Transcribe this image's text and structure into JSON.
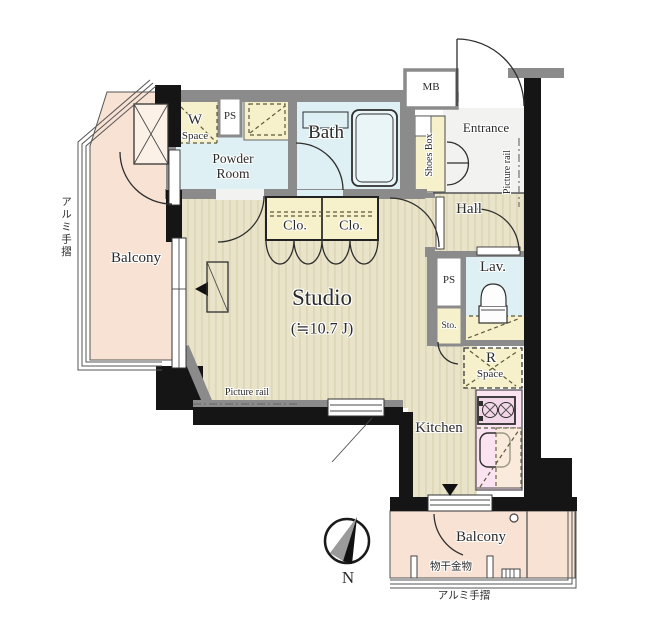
{
  "labels": {
    "balcony_left": "Balcony",
    "handrail_left": "アルミ手摺",
    "w_space": {
      "letter": "W",
      "word": "Space"
    },
    "ps_top": "PS",
    "powder_room": {
      "line1": "Powder",
      "line2": "Room"
    },
    "bath": "Bath",
    "mb": "MB",
    "entrance": "Entrance",
    "shoes_box": "Shoes Box",
    "picture_rail_entrance": "Picture rail",
    "hall": "Hall",
    "lav": "Lav.",
    "ps_hall": "PS",
    "sto": "Sto.",
    "r_space": {
      "letter": "R",
      "word": "Space"
    },
    "studio": {
      "name": "Studio",
      "size": "(≒10.7 J)"
    },
    "picture_rail_studio": "Picture rail",
    "kitchen": "Kitchen",
    "closet_left": "Clo.",
    "closet_right": "Clo.",
    "balcony_bottom": "Balcony",
    "laundry_hardware": "物干金物",
    "handrail_bottom": "アルミ手摺",
    "compass_north": "N"
  },
  "colors": {
    "wall": "#8b8b8b",
    "ink": "#151515",
    "floor": "#e9e4c9",
    "floor_stripe": "#d6d0ae",
    "water": "#def0f4",
    "storage": "#f6f0cb",
    "balcony": "#f8e2d4",
    "counter": "#fce3f1",
    "entrance": "#f2f2f0"
  }
}
